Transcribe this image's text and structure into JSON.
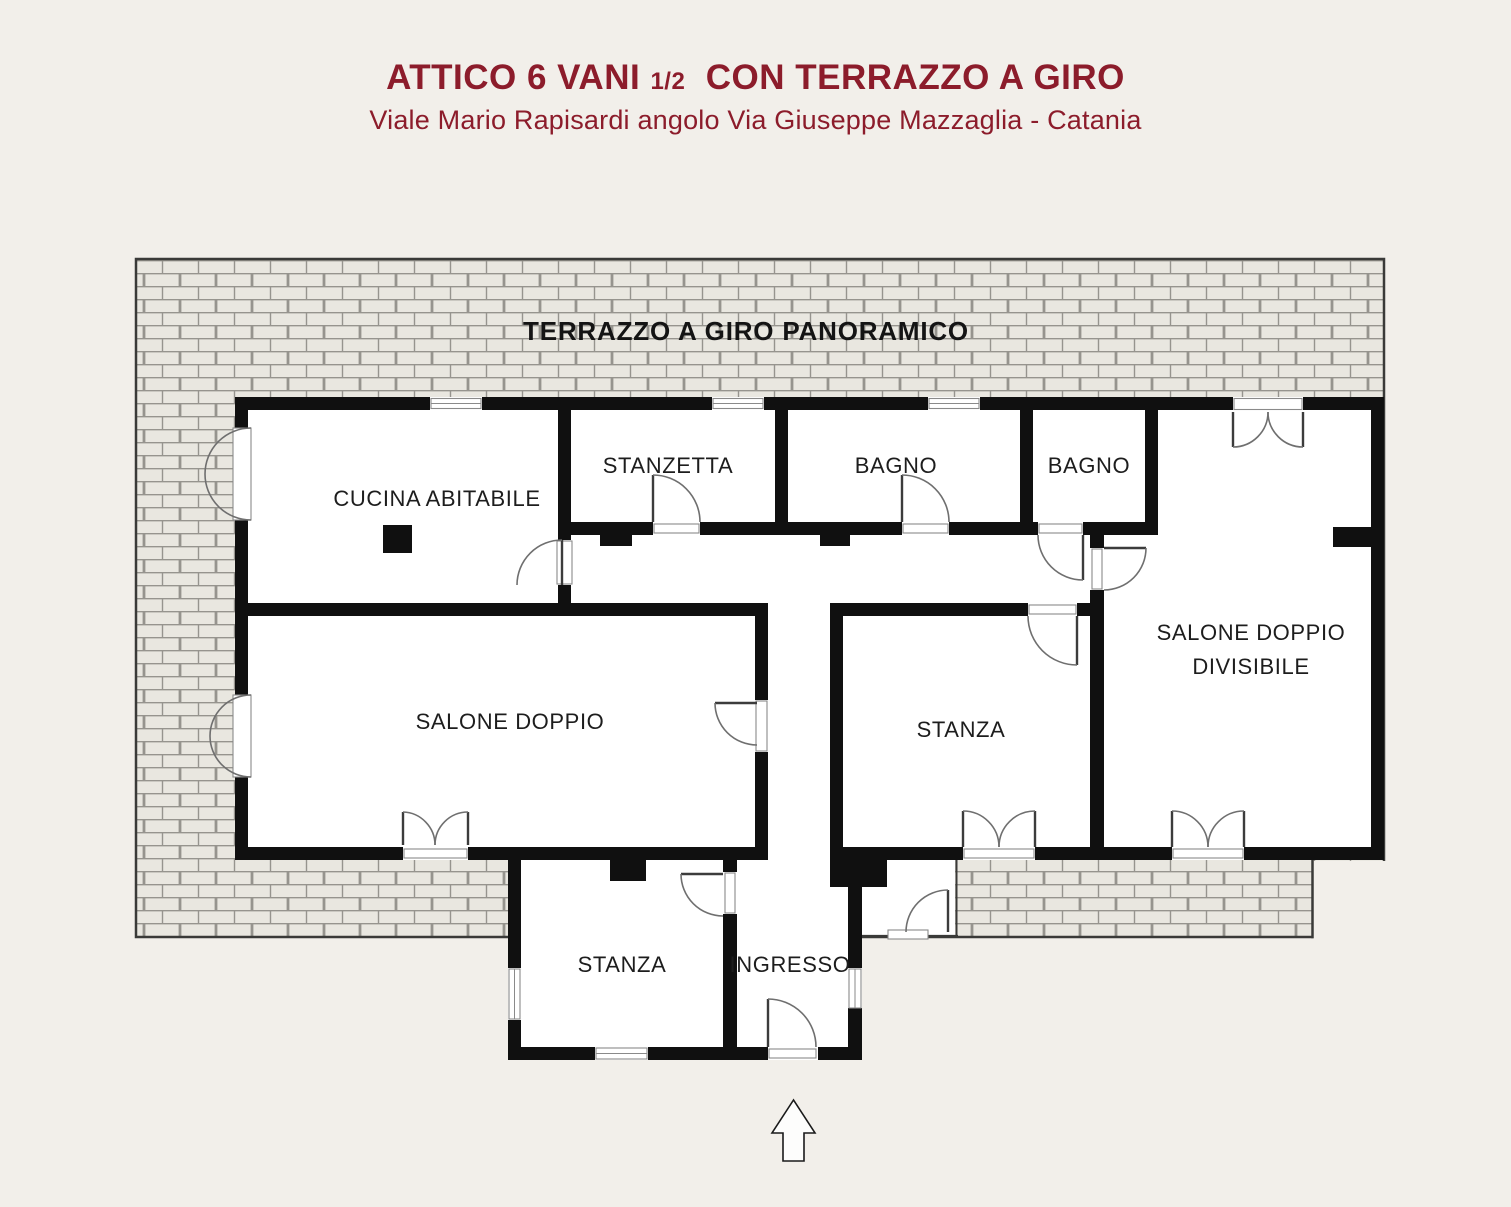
{
  "page": {
    "background": "#f2efea"
  },
  "header": {
    "title_part1": "ATTICO 6 VANI",
    "title_fraction": "1/2",
    "title_part2": "CON TERRAZZO A GIRO",
    "subtitle": "Viale Mario Rapisardi angolo Via Giuseppe Mazzaglia - Catania",
    "accent_color": "#8c1c2b"
  },
  "floorplan": {
    "terrace_label": "TERRAZZO A GIRO PANORAMICO",
    "colors": {
      "wall": "#101010",
      "brick_fill": "#e9e7e0",
      "brick_mortar": "#96948e",
      "terrace_border": "#3a3a38",
      "room_floor": "#ffffff"
    },
    "rooms": [
      {
        "label": "CUCINA ABITABILE"
      },
      {
        "label": "STANZETTA"
      },
      {
        "label": "BAGNO"
      },
      {
        "label": "BAGNO"
      },
      {
        "label": "SALONE DOPPIO",
        "label2": "DIVISIBILE"
      },
      {
        "label": "SALONE DOPPIO"
      },
      {
        "label": "STANZA"
      },
      {
        "label": "STANZA"
      },
      {
        "label": "INGRESSO"
      }
    ],
    "north_arrow": "up-arrow"
  }
}
